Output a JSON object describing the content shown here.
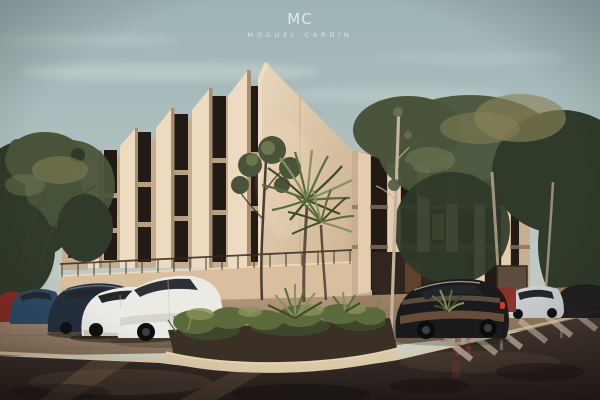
{
  "logo": {
    "monogram": "MC",
    "name": "MOGUEL CARDIN"
  },
  "scene": {
    "type": "architectural-exterior-rendering",
    "description": "Dusk rendering of a three-story residential building with slanted cream concrete fin walls and tall dark windows, framed by trees; white, navy, red and black cars parked along a wet street corner with a curved planter of tropical plants and a zebra crossing on the right",
    "palette": {
      "sky_top": "#9db3b6",
      "sky_mid": "#b6c5c2",
      "sky_low": "#d3d3c4",
      "cloud": "#e8ece6",
      "tree_dark": "#2f3a2a",
      "tree_mid": "#49543a",
      "tree_light": "#7d815a",
      "tree_warm": "#8a8258",
      "fin_lit": "#eedbbf",
      "fin_face": "#e3cdae",
      "fin_shadow": "#a98f71",
      "wall_bay": "#c6ad8e",
      "wall_corner": "#e9d6ba",
      "wall_corner2": "#c9af90",
      "window_dark": "#221b15",
      "window_lit": "#d89a55",
      "slab": "#b89f82",
      "base_wall": "#d9bf9e",
      "railing": "#332b23",
      "trunk_light": "#c4b29a",
      "trunk_dark": "#4a3c30",
      "car_white": "#eceae5",
      "car_white_shade": "#c9c4bb",
      "car_navy": "#242e3e",
      "car_blue": "#2c4a66",
      "car_red": "#8a2b26",
      "car_black": "#1a1a1d",
      "car_silver": "#ccd0d2",
      "glass_dark": "#23262b",
      "pave_left": "#b3977a",
      "pave_right": "#a08465",
      "pave_dark": "#84705c",
      "curb": "#dcc9a7",
      "soil": "#3b3026",
      "road_top": "#4a3c33",
      "road_bottom": "#221c19",
      "road_streak": "#96795f",
      "road_dark": "#161210",
      "reflect_red": "#a23a2c",
      "stripe": "#cfc2b0",
      "plant_dark": "#3d4a2e",
      "plant_mid": "#5c6b3c",
      "plant_light": "#87915a",
      "suv_reflect": "#7a5a40",
      "taillight": "#d03a2a",
      "logo_ink": "#e9efee"
    }
  }
}
